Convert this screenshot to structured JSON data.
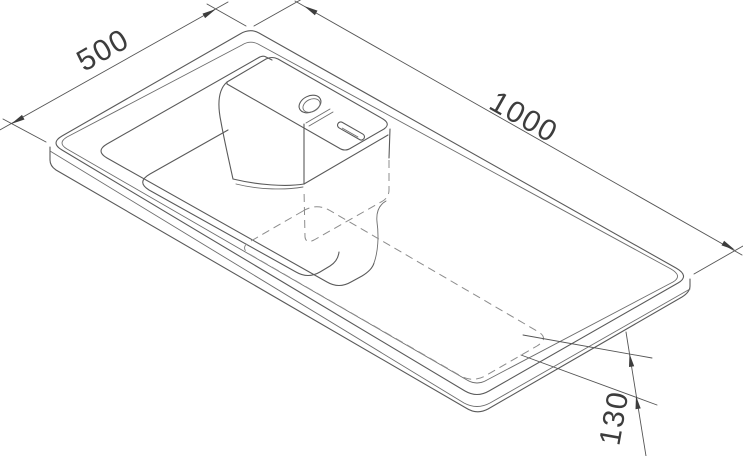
{
  "drawing": {
    "kind": "isometric technical drawing",
    "subject": "countertop washbasin with left bowl, tap deck, faucet hole and overflow slot",
    "dimensions": {
      "width": {
        "value": "500"
      },
      "length": {
        "value": "1000"
      },
      "height": {
        "value": "130"
      }
    },
    "line_styles": {
      "visible_edges": "solid",
      "hidden_edges": "dashed"
    },
    "colors": {
      "background": "#ffffff",
      "solid_line": "#5a5a5a",
      "hidden_line": "#8c8c8c",
      "dimension_line": "#555555",
      "text": "#3d3d3d"
    }
  }
}
